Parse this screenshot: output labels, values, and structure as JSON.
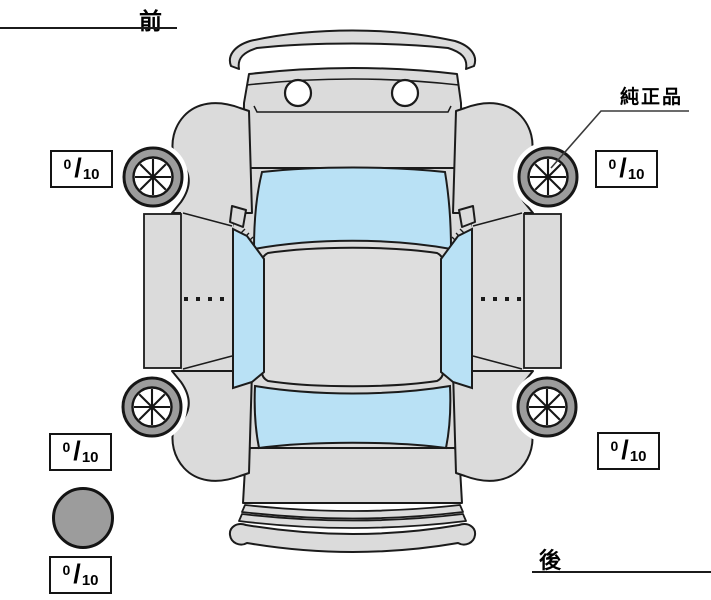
{
  "diagram": {
    "title_front": "前",
    "title_rear": "後",
    "genuine_parts_label": "純正品"
  },
  "tread_depths": {
    "separator": "/",
    "front_left": {
      "value": "0",
      "max": "10"
    },
    "front_right": {
      "value": "0",
      "max": "10"
    },
    "rear_left": {
      "value": "0",
      "max": "10"
    },
    "rear_right": {
      "value": "0",
      "max": "10"
    },
    "spare": {
      "value": "0",
      "max": "10"
    }
  },
  "colors": {
    "background": "#ffffff",
    "body_gray": "#dbdbdb",
    "roof_gray": "#dedede",
    "glass_blue": "#b9e1f5",
    "tire_gray": "#9c9c9c",
    "outline": "#1b1b1b"
  },
  "icons": {
    "car": "car-top-view-icon",
    "wheel": "wheel-spoke-icon",
    "spare": "spare-tire-icon"
  }
}
